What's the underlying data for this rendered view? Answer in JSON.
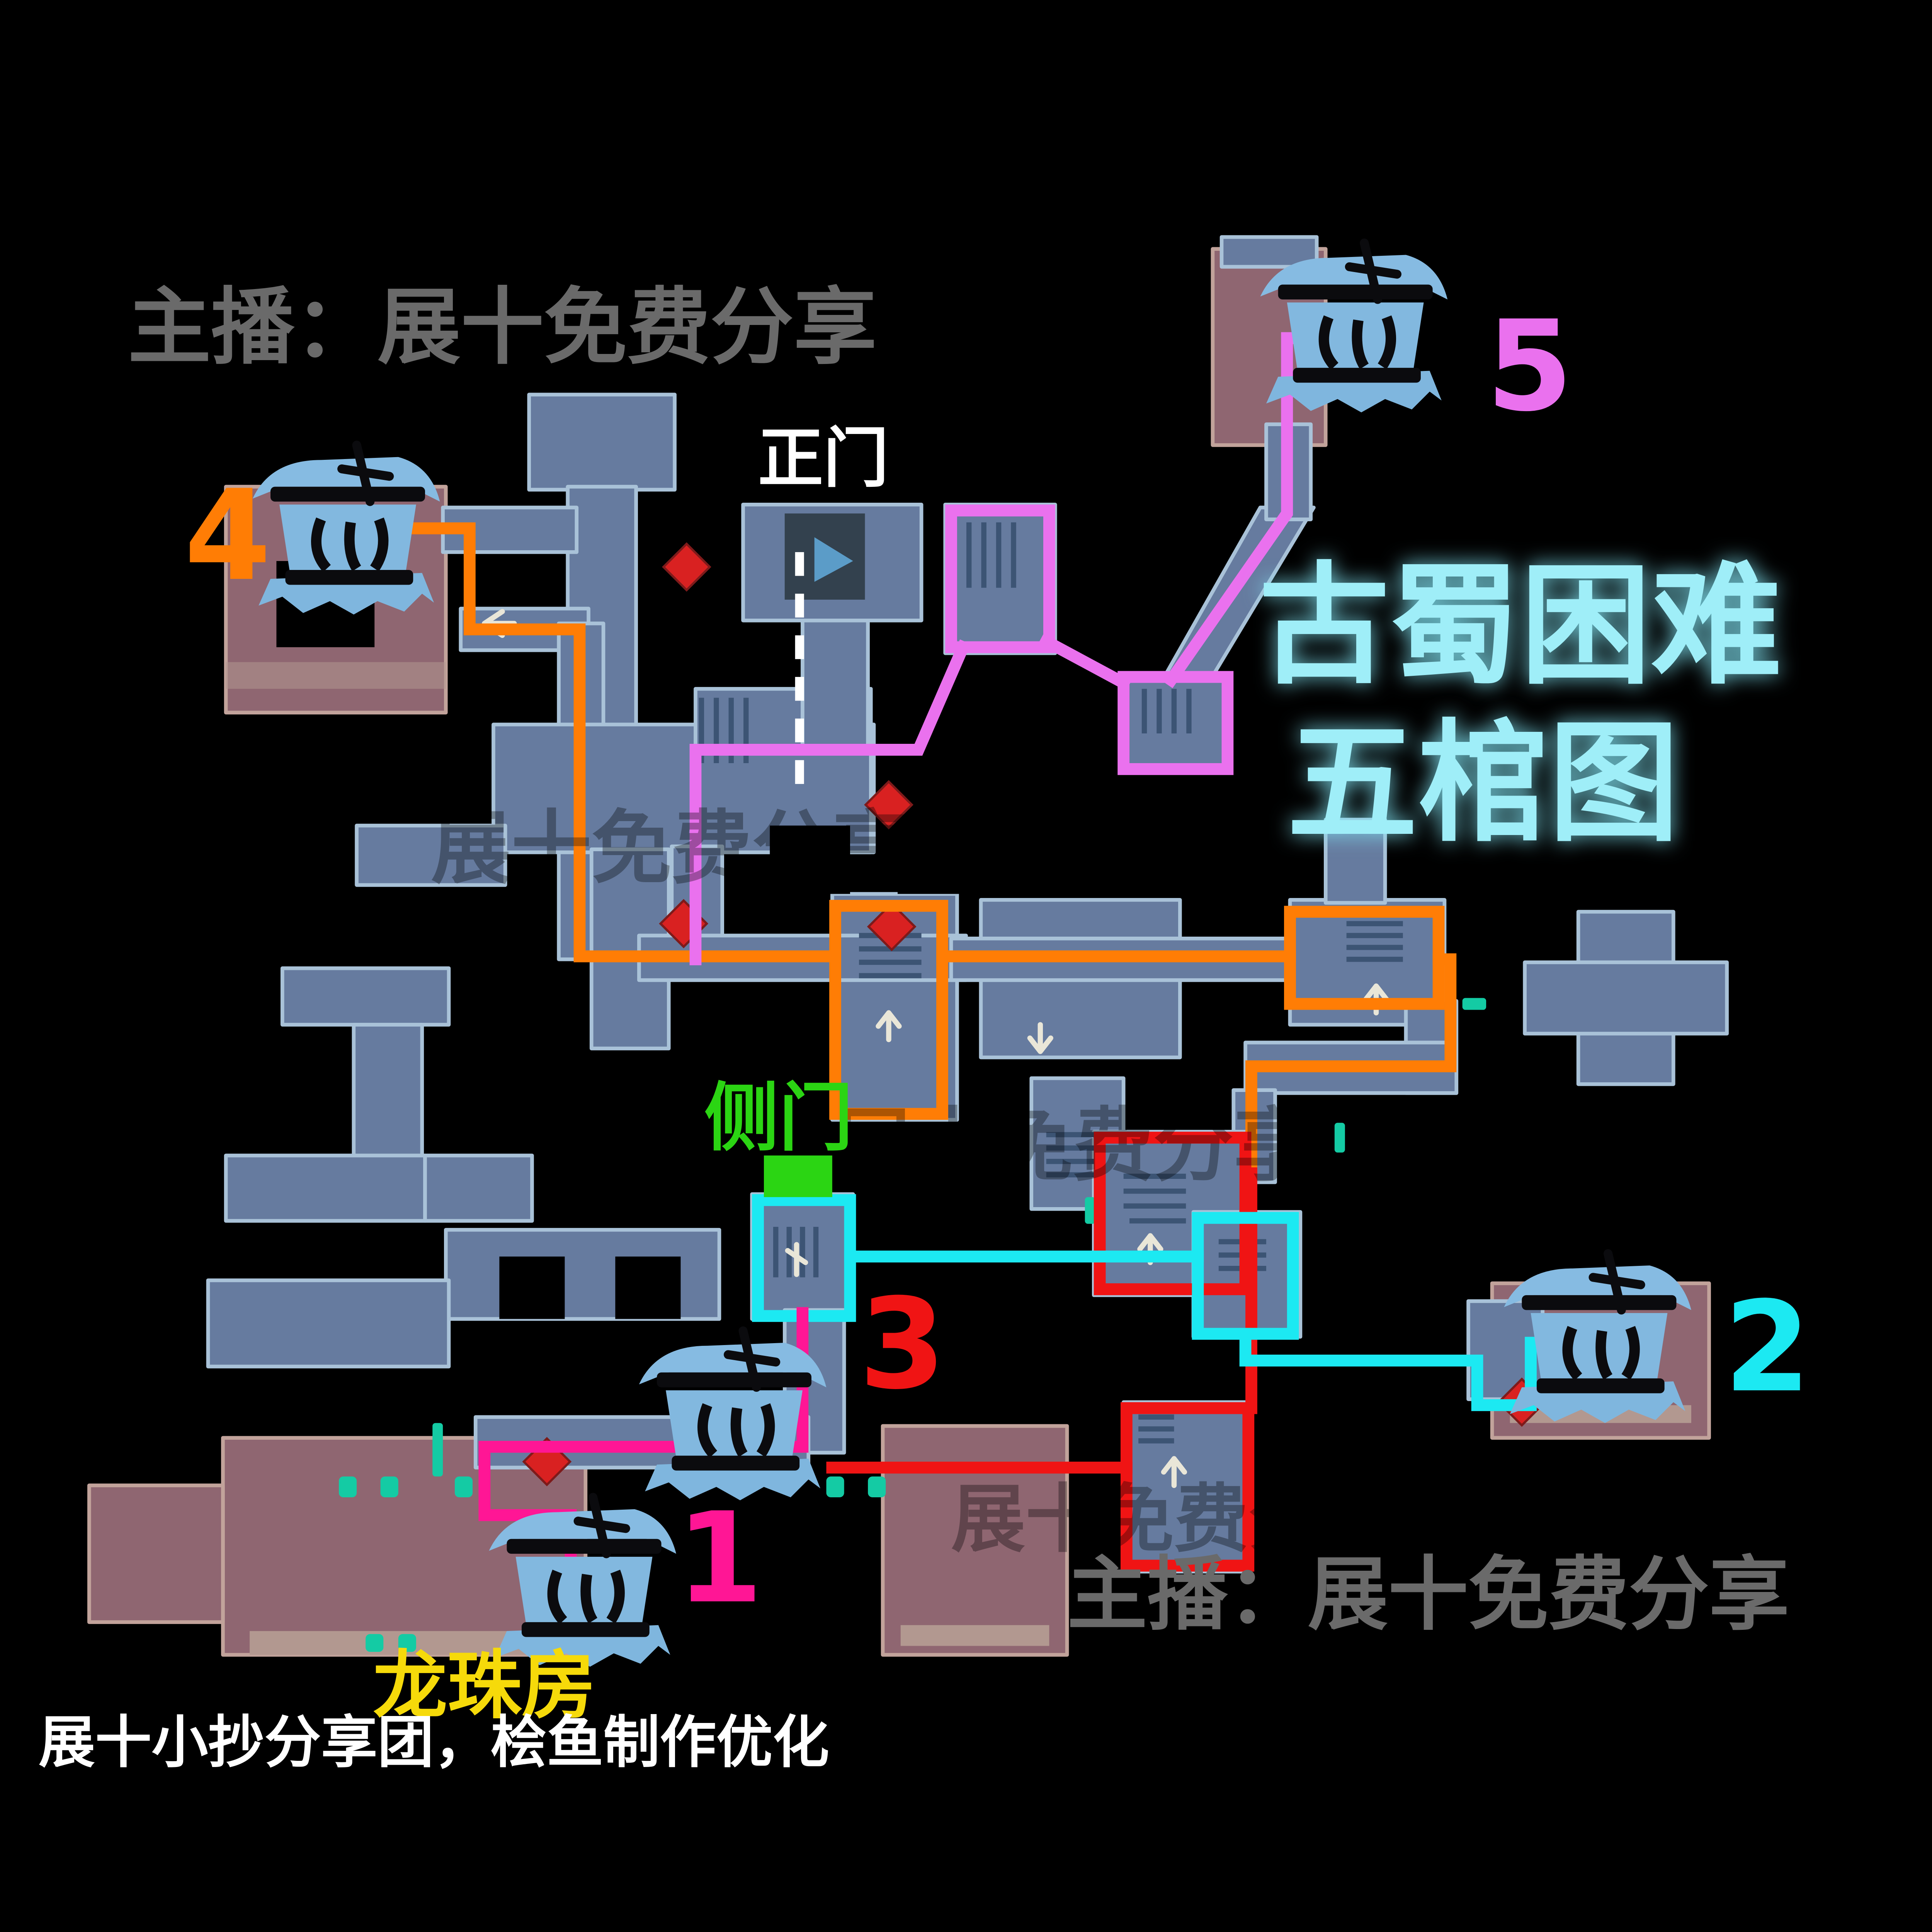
{
  "watermarks": {
    "top_left": "主播：展十免费分享",
    "bottom_right": "主播：展十免费分享",
    "credit": "展十小抄分享团，桧鱼制作优化",
    "ghost": "展十免费分享"
  },
  "title": {
    "line1": "古蜀困难",
    "line2": "五棺图",
    "color": "#9feef8"
  },
  "labels": {
    "main_gate": {
      "text": "正门",
      "color": "#ffffff"
    },
    "side_gate": {
      "text": "侧门",
      "color": "#2bd513"
    },
    "dragon_pearl_room": {
      "text": "龙珠房",
      "color": "#f6da0a"
    }
  },
  "coffins": [
    {
      "id": 1,
      "label": "1",
      "color": "#ff1695"
    },
    {
      "id": 2,
      "label": "2",
      "color": "#1ce9f2"
    },
    {
      "id": 3,
      "label": "3",
      "color": "#f01414"
    },
    {
      "id": 4,
      "label": "4",
      "color": "#ff7d05"
    },
    {
      "id": 5,
      "label": "5",
      "color": "#ea71ee"
    }
  ],
  "routes": [
    {
      "name": "route-coffin-1",
      "color": "#ff1695"
    },
    {
      "name": "route-coffin-2",
      "color": "#1ce9f2"
    },
    {
      "name": "route-coffin-3",
      "color": "#f01414"
    },
    {
      "name": "route-coffin-4",
      "color": "#ff7d05"
    },
    {
      "name": "route-coffin-5",
      "color": "#ea71ee"
    },
    {
      "name": "main-gate-entry",
      "color": "#ffffff",
      "style": "dashed"
    }
  ],
  "map_colors": {
    "background": "#000000",
    "room_fill": "#667b9f",
    "room_wall": "#a9c2d8",
    "red_room_fill": "#8f6671",
    "red_room_wall": "#c2a39b",
    "marker_red": "#d92121",
    "door_teal": "#14cba4",
    "door_green": "#2bd513",
    "coffin_icon_blue": "#7fb6de"
  }
}
